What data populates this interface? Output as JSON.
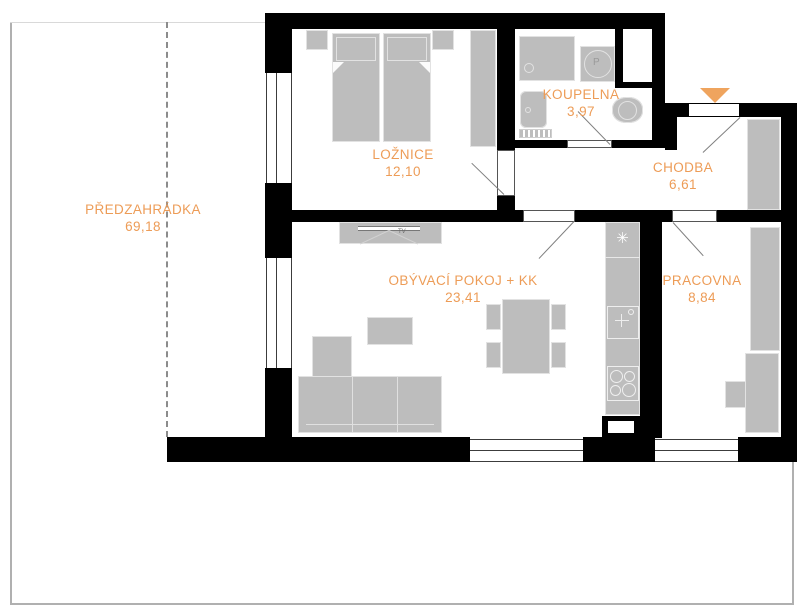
{
  "plan": {
    "rooms": {
      "predzahradka": {
        "name": "PŘEDZAHRÁDKA",
        "area": "69,18"
      },
      "loznice": {
        "name": "LOŽNICE",
        "area": "12,10"
      },
      "koupelna": {
        "name": "KOUPELNA",
        "area": "3,97"
      },
      "chodba": {
        "name": "CHODBA",
        "area": "6,61"
      },
      "obyvaci": {
        "name": "OBÝVACÍ POKOJ + KK",
        "area": "23,41"
      },
      "pracovna": {
        "name": "PRACOVNA",
        "area": "8,84"
      }
    },
    "symbols": {
      "washer_letter": "P",
      "fridge_snowflake": "✳",
      "tv_label": "TV"
    },
    "colors": {
      "room_label": "#ED9C57",
      "entrance_arrow": "#EFA45E",
      "wall": "#000000",
      "furniture_fill": "#BDBDBD"
    }
  }
}
